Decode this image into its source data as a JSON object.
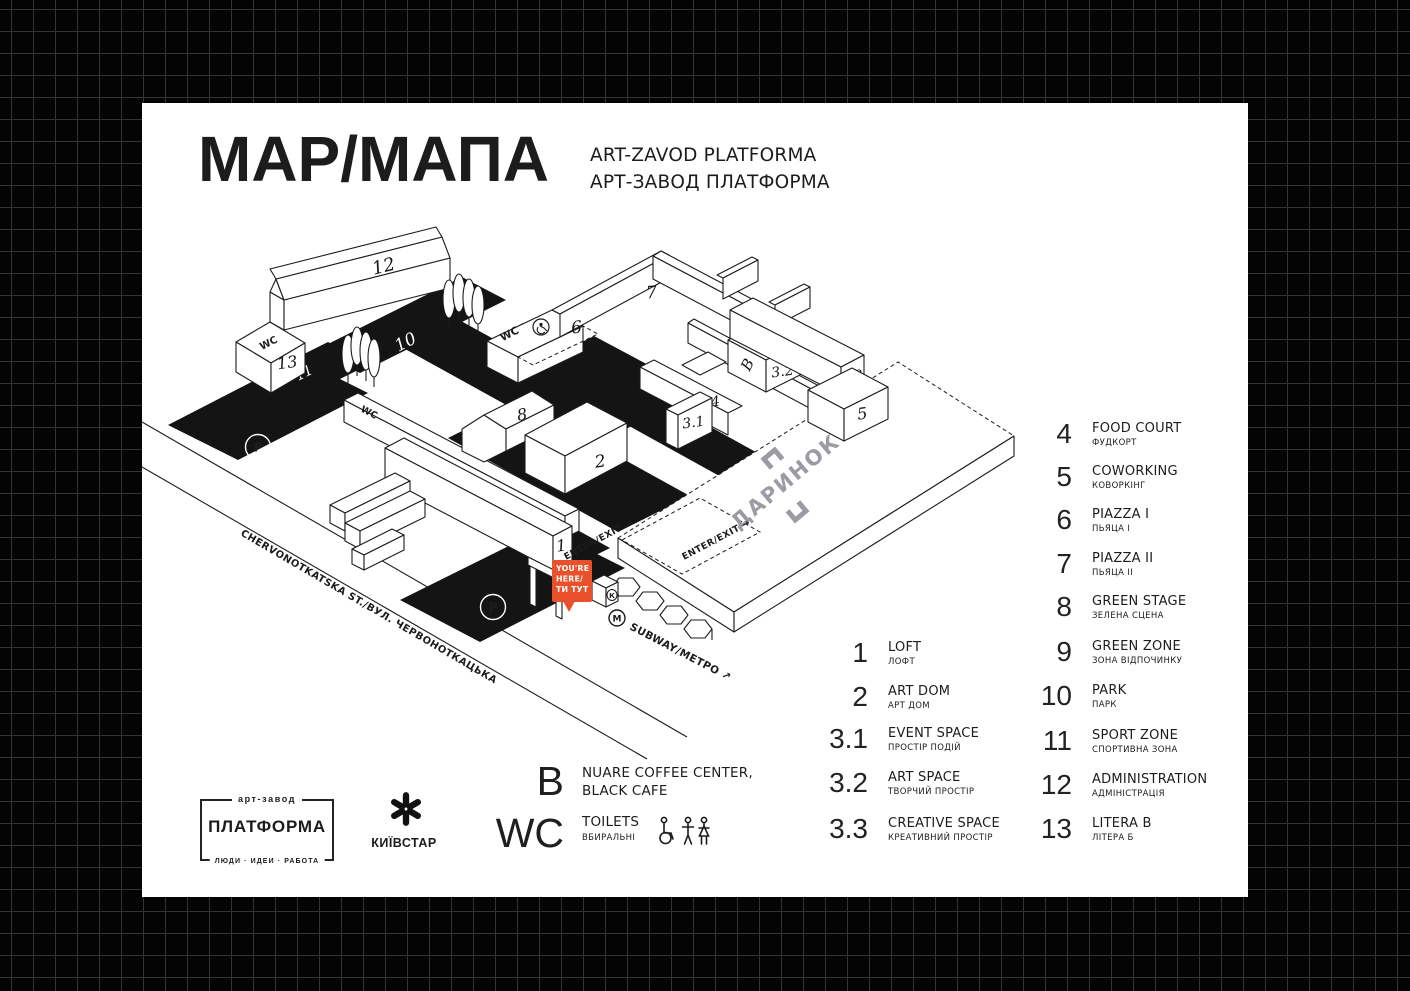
{
  "header": {
    "title": "MAP/МАПА",
    "subtitle_en": "ART-ZAVOD PLATFORMA",
    "subtitle_ua": "АРТ-ЗАВОД ПЛАТФОРМА"
  },
  "map": {
    "street_name": "CHERVONOTKATSKA ST./ВУЛ. ЧЕРВОНОТКАЦЬКА",
    "darynok": "ДАРИНОК",
    "subway": "SUBWAY/МЕТРО ↗",
    "enter_exit": "ENTER/EXIT →",
    "you_are_here": [
      "YOU'RE",
      "HERE/",
      "ТИ ТУТ"
    ],
    "metro_m": "M",
    "kiosk_k": "К",
    "parking_p": "P",
    "wc": "WC",
    "numbers": {
      "n1": "1",
      "n2": "2",
      "n31": "3.1",
      "n32": "3.2",
      "n33": "3.3",
      "n4": "4",
      "n5": "5",
      "n6": "6",
      "n7": "7",
      "n8": "8",
      "n9": "9",
      "n10": "10",
      "n11": "11",
      "n12": "12",
      "n13": "13",
      "b": "B"
    }
  },
  "legend": {
    "column1": [
      {
        "num": "1",
        "en": "LOFT",
        "ua": "ЛОФТ"
      },
      {
        "num": "2",
        "en": "ART DOM",
        "ua": "АРТ ДОМ"
      },
      {
        "num": "3.1",
        "en": "EVENT SPACE",
        "ua": "ПРОСТІР ПОДІЙ"
      },
      {
        "num": "3.2",
        "en": "ART SPACE",
        "ua": "ТВОРЧИЙ ПРОСТІР"
      },
      {
        "num": "3.3",
        "en": "CREATIVE SPACE",
        "ua": "КРЕАТИВНИЙ ПРОСТІР"
      }
    ],
    "column2": [
      {
        "num": "4",
        "en": "FOOD COURT",
        "ua": "ФУДКОРТ"
      },
      {
        "num": "5",
        "en": "COWORKING",
        "ua": "КОВОРКІНГ"
      },
      {
        "num": "6",
        "en": "PIAZZA I",
        "ua": "ПЬЯЦА I"
      },
      {
        "num": "7",
        "en": "PIAZZA II",
        "ua": "ПЬЯЦА II"
      },
      {
        "num": "8",
        "en": "GREEN STAGE",
        "ua": "ЗЕЛЕНА СЦЕНА"
      },
      {
        "num": "9",
        "en": "GREEN ZONE",
        "ua": "ЗОНА ВІДПОЧИНКУ"
      },
      {
        "num": "10",
        "en": "PARK",
        "ua": "ПАРК"
      },
      {
        "num": "11",
        "en": "SPORT ZONE",
        "ua": "СПОРТИВНА ЗОНА"
      },
      {
        "num": "12",
        "en": "ADMINISTRATION",
        "ua": "АДМІНІСТРАЦІЯ"
      },
      {
        "num": "13",
        "en": "LITERA B",
        "ua": "ЛІТЕРА Б"
      }
    ],
    "cafe": {
      "sym": "B",
      "line1": "NUARE COFFEE CENTER,",
      "line2": "BLACK CAFE"
    },
    "toilets": {
      "sym": "WC",
      "en": "TOILETS",
      "ua": "ВБИРАЛЬНІ"
    }
  },
  "footer": {
    "platforma": {
      "top": "арт-завод",
      "name": "ПЛАТФОРМА",
      "bottom": "ЛЮДИ · ИДЕИ · РАБОТА"
    },
    "kyivstar": {
      "name": "КИЇВСТАР"
    }
  },
  "colors": {
    "accent_orange": "#E8512B",
    "darynok_gray": "#9B9BA3",
    "ink": "#1C1C1C",
    "card_bg": "#FFFFFF",
    "page_bg": "#040404",
    "grid_line": "#343434"
  }
}
